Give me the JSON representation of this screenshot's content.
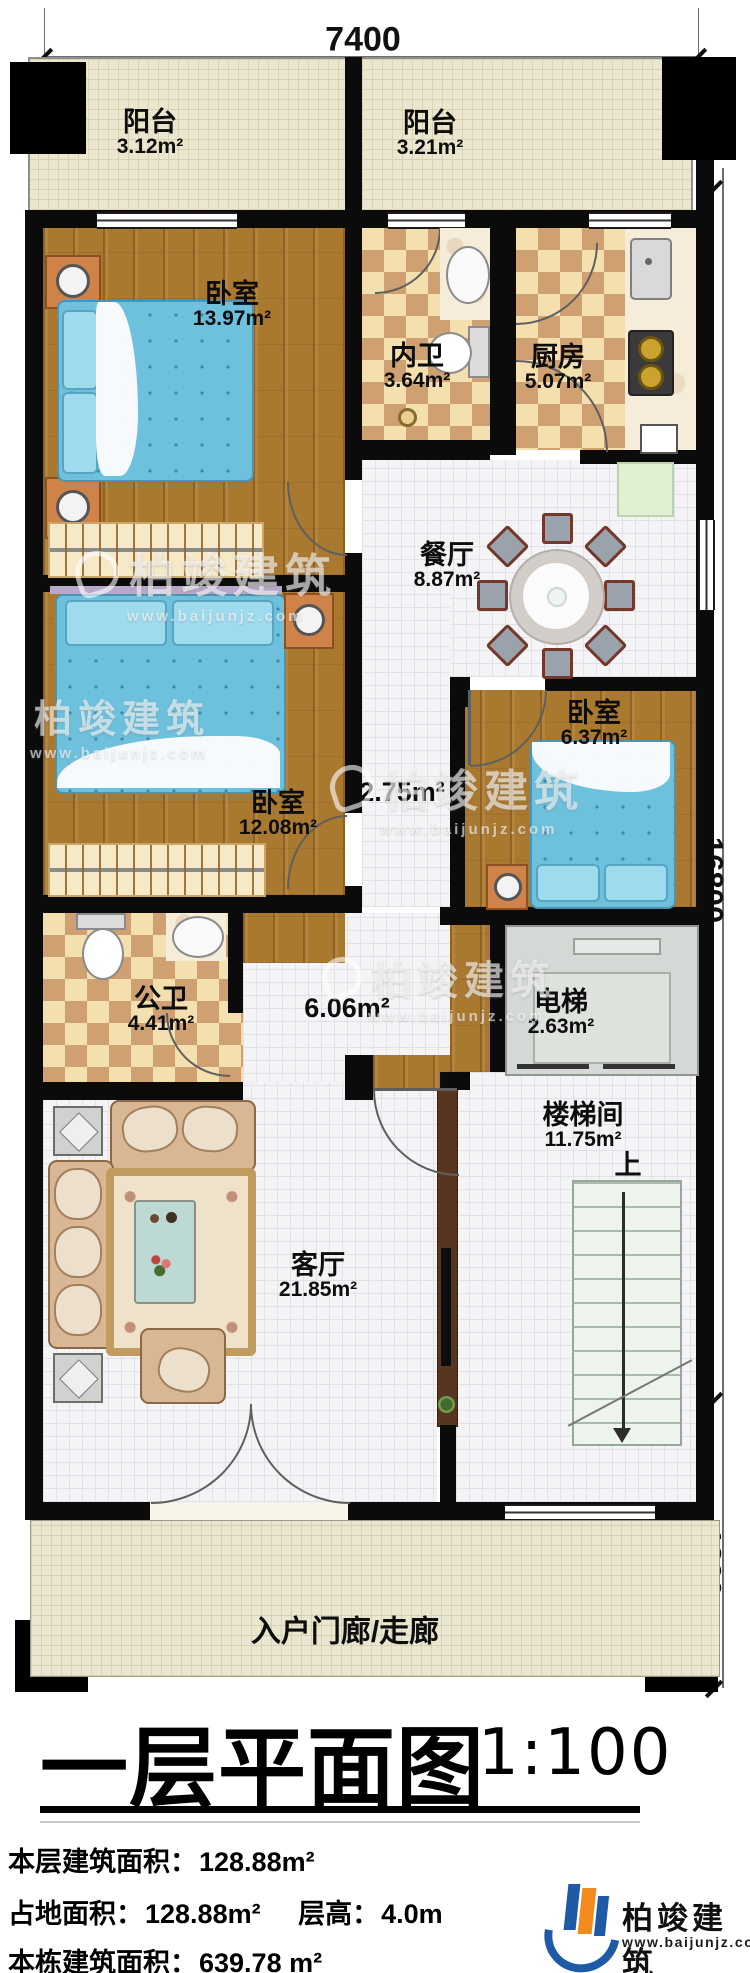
{
  "sheet": {
    "title": "一层平面图",
    "scale_label": "1:100"
  },
  "dimensions": {
    "top": "7400",
    "right_main": "16800",
    "right_porch": "1800"
  },
  "rooms": {
    "balcony_left": {
      "name": "阳台",
      "area": "3.12m²"
    },
    "balcony_right": {
      "name": "阳台",
      "area": "3.21m²"
    },
    "bedroom_top": {
      "name": "卧室",
      "area": "13.97m²"
    },
    "inner_bath": {
      "name": "内卫",
      "area": "3.64m²"
    },
    "kitchen": {
      "name": "厨房",
      "area": "5.07m²"
    },
    "dining": {
      "name": "餐厅",
      "area": "8.87m²"
    },
    "bedroom_mid": {
      "name": "卧室",
      "area": "12.08m²"
    },
    "bedroom_right": {
      "name": "卧室",
      "area": "6.37m²"
    },
    "public_bath": {
      "name": "公卫",
      "area": "4.41m²"
    },
    "elevator": {
      "name": "电梯",
      "area": "2.63m²"
    },
    "stair_hall": {
      "name": "楼梯间",
      "area": "11.75m²",
      "up": "上"
    },
    "living": {
      "name": "客厅",
      "area": "21.85m²"
    },
    "corridor": {
      "area": "2.75m²"
    },
    "hallway": {
      "area": "6.06m²"
    },
    "porch": {
      "name": "入户门廊/走廊"
    }
  },
  "stats": [
    {
      "segs": [
        {
          "label": "本层建筑面积：",
          "value": "128.88m²"
        }
      ]
    },
    {
      "segs": [
        {
          "label": "占地面积：",
          "value": "128.88m²"
        },
        {
          "label": "层高：",
          "value": "4.0m"
        }
      ]
    },
    {
      "segs": [
        {
          "label": "本栋建筑面积：",
          "value": "639.78 m²"
        }
      ]
    }
  ],
  "brand": {
    "name": "柏竣建筑",
    "url": "www.baijunjz.com"
  },
  "watermark": {
    "name": "柏竣建筑",
    "url": "www.baijunjz.com"
  },
  "colors": {
    "wall": "#0b0b0b",
    "wood_floor": "#aa7930",
    "tile_light": "#f4f4f6",
    "checker_light": "#f4dfae",
    "checker_dark": "#cfa071",
    "balcony": "#ebe6cf",
    "bed_blue": "#6ec1dd",
    "nightstand_orange": "#d08348",
    "elevator_gray": "#d4d9d5",
    "brand_blue": "#1e5aa5",
    "brand_orange": "#f28a1d"
  }
}
